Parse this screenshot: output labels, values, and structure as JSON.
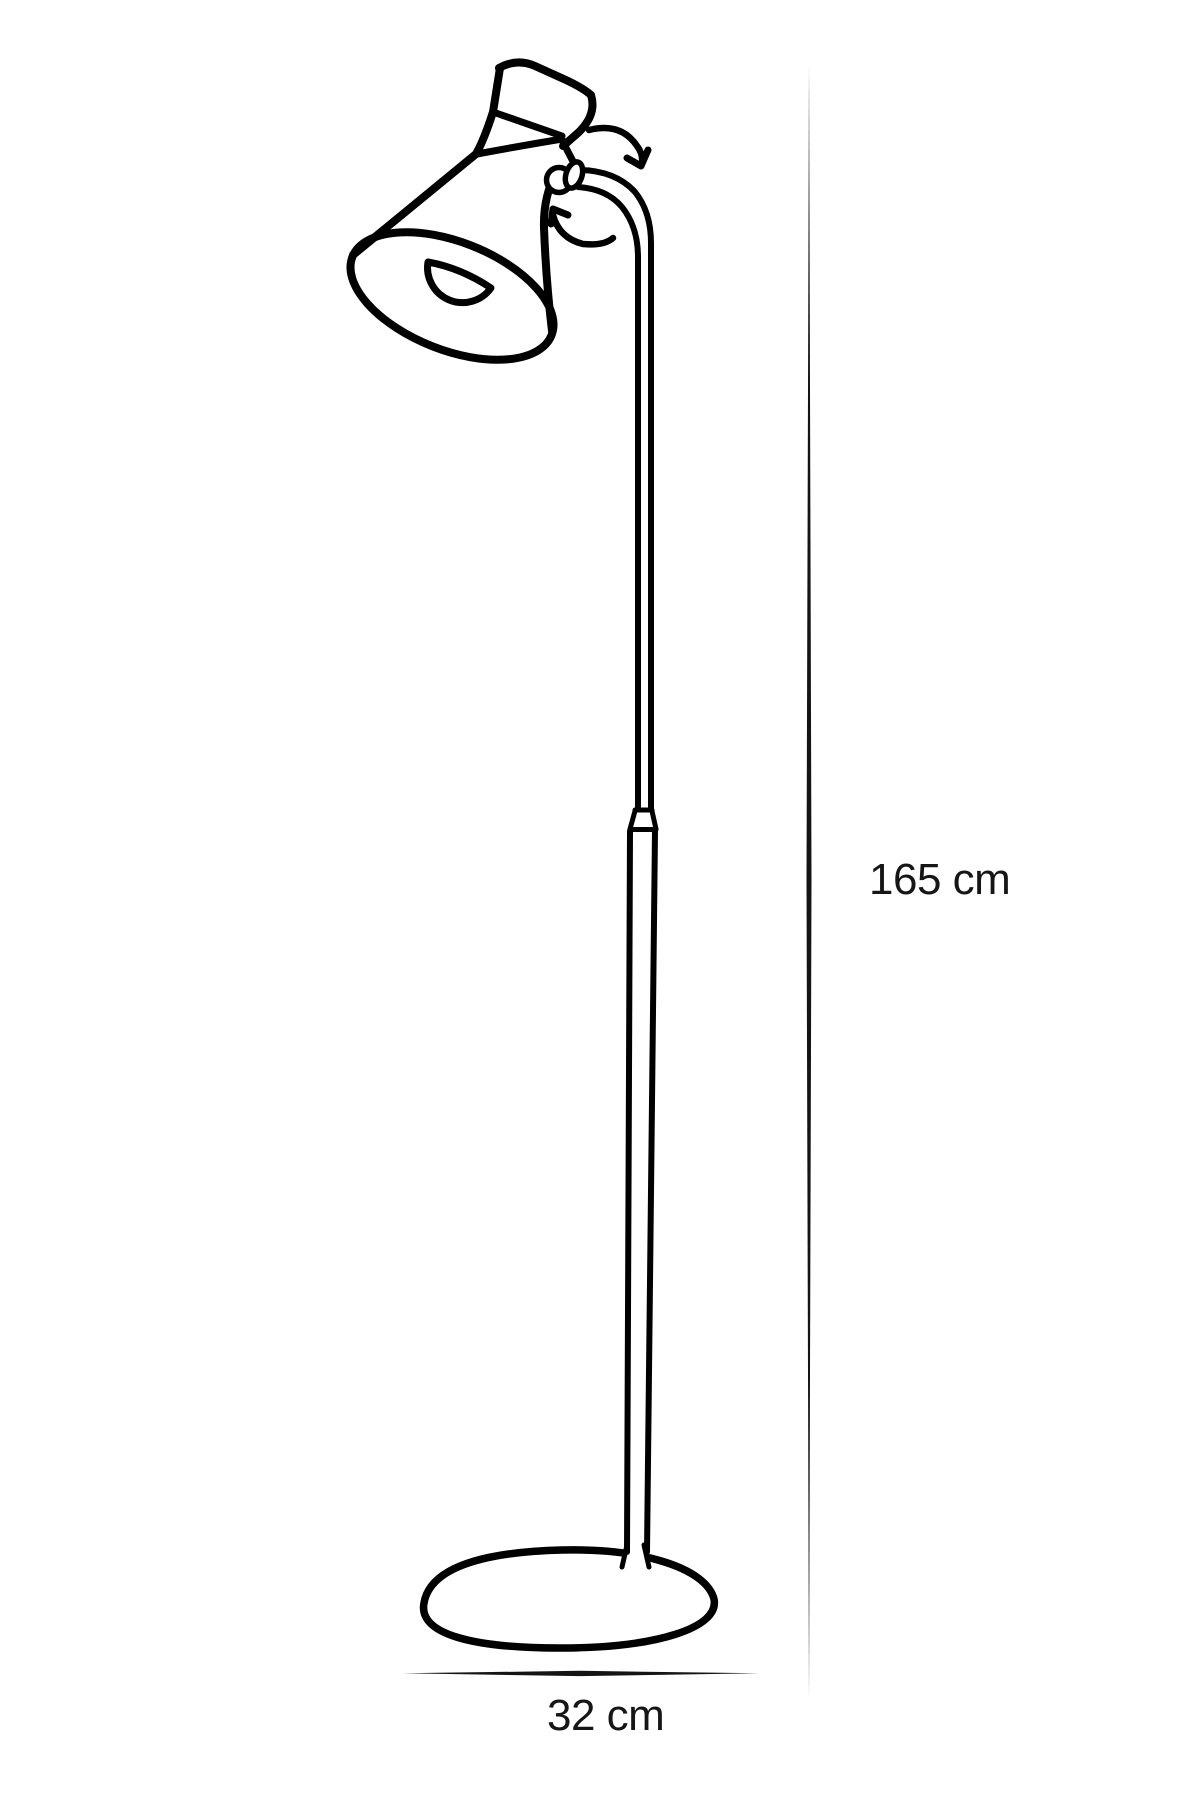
{
  "diagram": {
    "type": "product-dimension-line-drawing",
    "dimensions": {
      "height_label": "165 cm",
      "width_label": "32 cm"
    },
    "colors": {
      "line": "#000000",
      "text": "#161616",
      "background": "#ffffff"
    },
    "illustration_parts": [
      "lamp-shade-icon",
      "light-bulb-icon",
      "swivel-knob-icon",
      "rotation-arrow-clockwise-icon",
      "rotation-arrow-counterclockwise-icon",
      "lamp-pole-icon",
      "pole-joint-icon",
      "lamp-base-icon",
      "height-dimension-line",
      "width-dimension-line"
    ]
  }
}
